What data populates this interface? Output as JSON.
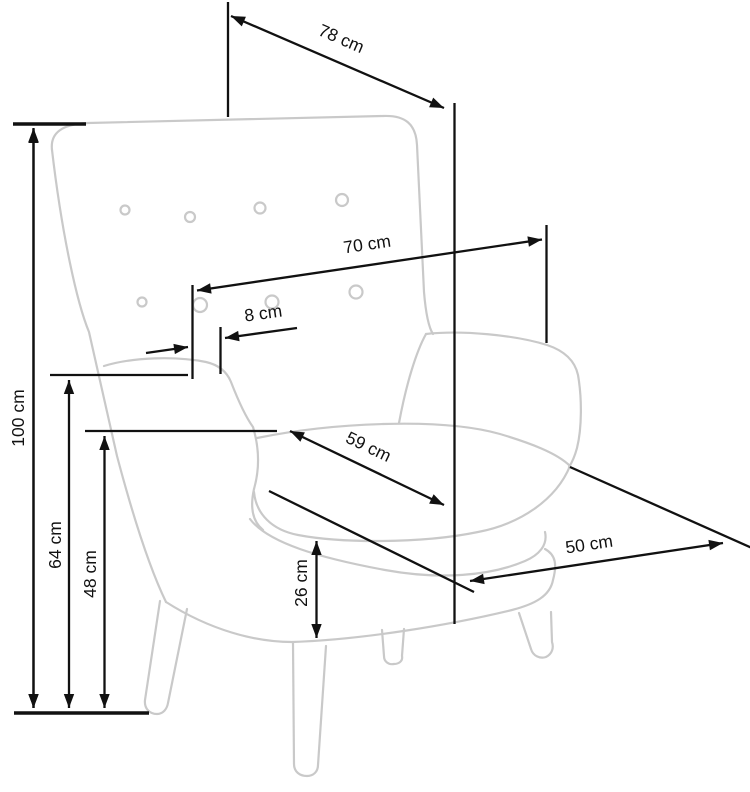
{
  "diagram": {
    "subject": "armchair",
    "unit_labels": {
      "d100": {
        "label": "100 cm"
      },
      "d78": {
        "label": "78 cm"
      },
      "d70": {
        "label": "70 cm"
      },
      "d8": {
        "label": "8 cm"
      },
      "d64": {
        "label": "64 cm"
      },
      "d48": {
        "label": "48 cm"
      },
      "d59": {
        "label": "59 cm"
      },
      "d26": {
        "label": "26 cm"
      },
      "d50": {
        "label": "50 cm"
      }
    }
  },
  "colors": {
    "background": "#ffffff",
    "chair_outline": "#c9c9c9",
    "dimension_line": "#111111",
    "label_text": "#111111"
  }
}
